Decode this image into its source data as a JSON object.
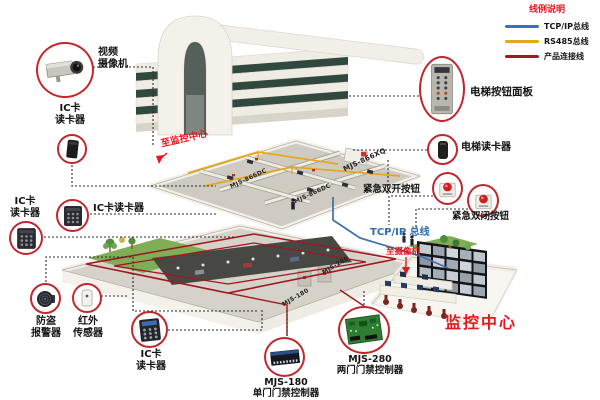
{
  "legend": {
    "title": "线例说明",
    "items": [
      {
        "label": "TCP/IP总线",
        "color": "#3e6fae"
      },
      {
        "label": "RS485总线",
        "color": "#e3a81e"
      },
      {
        "label": "产品连接线",
        "color": "#9c1a1f"
      }
    ]
  },
  "building": {
    "floor_units": [
      "MJS-866DC",
      "MJS-866XQ",
      "MJS-866DC"
    ],
    "basement_units": [
      "MJS-280",
      "MJS-180"
    ]
  },
  "devices": {
    "camera": "视频\n摄像机",
    "ic_reader_top": "IC卡\n读卡器",
    "ic_reader_mid_side": "IC卡\n读卡器",
    "ic_reader_mid": "IC卡读卡器",
    "burglar_alarm": "防盗\n报警器",
    "ir_sensor": "红外\n传感器",
    "ic_reader_bottom": "IC卡\n读卡器",
    "controller_single": "MJS-180\n单门门禁控制器",
    "controller_double": "MJS-280\n两门门禁控制器",
    "elevator_panel": "电梯按钮面板",
    "elevator_reader": "电梯读卡器",
    "emergency_open": "紧急双开按钮",
    "emergency_close": "紧急双闭按钮"
  },
  "annotations": {
    "tcpip_bus": "TCP/IP 总线",
    "to_camera": "至摄像机",
    "to_monitoring_center": "至监控中心",
    "monitoring_center": "监控中心"
  }
}
